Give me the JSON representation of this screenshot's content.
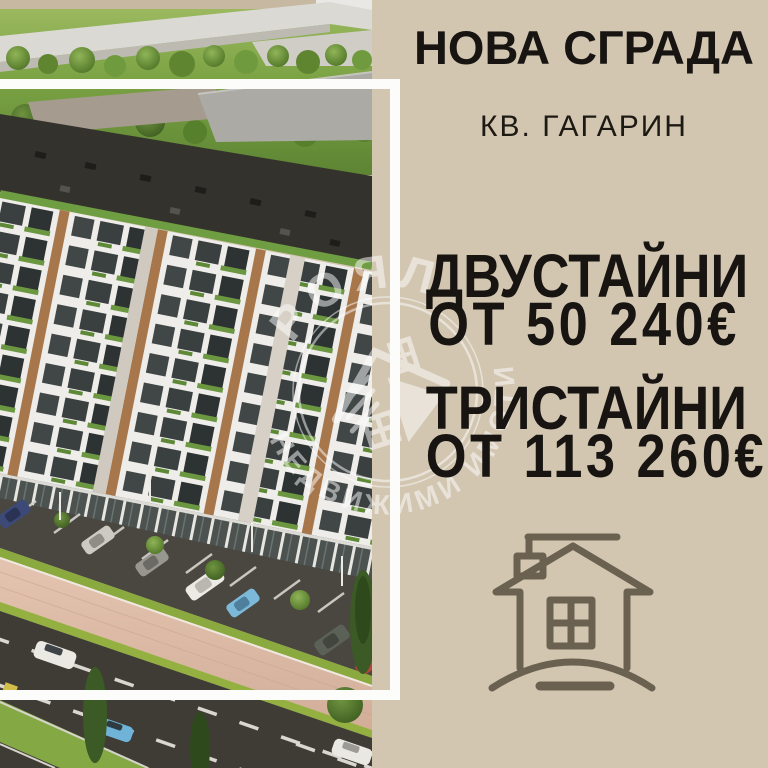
{
  "poster": {
    "headline": "НОВА СГРАДА",
    "location": "КВ. ГАГАРИН",
    "offers": [
      {
        "rooms": "ДВУСТАЙНИ",
        "price": "ОТ 50 240€"
      },
      {
        "rooms": "ТРИСТАЙНИ",
        "price": "ОТ 113 260€"
      }
    ],
    "watermark": {
      "brand": "РОЯЛ",
      "tagline": "НЕДВИЖИМИ ИМОТИ"
    },
    "photo": {
      "description": "aerial render of new white apartment building with street and parked cars"
    },
    "icons": {
      "bottom_right": "house-outline-icon"
    },
    "colors": {
      "background": "#d2c6b1",
      "text": "#171411",
      "frame": "#fcfcfa",
      "house_icon_stroke": "#6a6150",
      "watermark": "rgba(255,255,255,0.5)"
    }
  }
}
